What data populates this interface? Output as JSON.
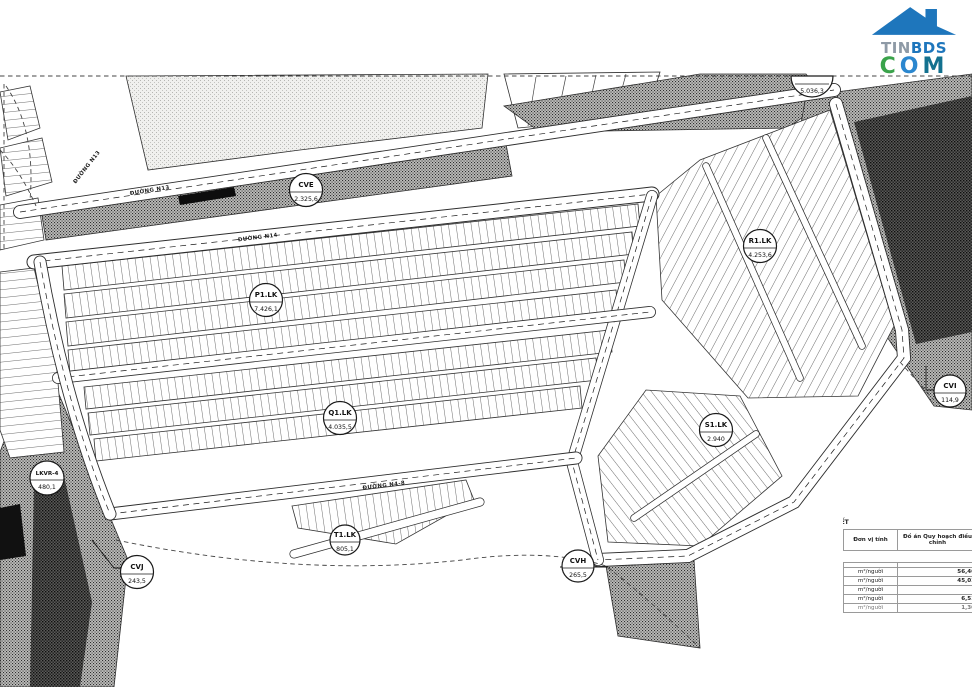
{
  "logo": {
    "tin": "TIN",
    "bds": "BDS",
    "c": "C",
    "o": "O",
    "m": "M",
    "roof_color": "#1e76bc"
  },
  "map": {
    "zones": [
      {
        "name": "CVE",
        "area": "2.325,6"
      },
      {
        "name": "P1.LK",
        "area": "7.426,1"
      },
      {
        "name": "Q1.LK",
        "area": "4.035,5"
      },
      {
        "name": "R1.LK",
        "area": "4.253,6"
      },
      {
        "name": "S1.LK",
        "area": "2.940"
      },
      {
        "name": "T1.LK",
        "area": "805,1"
      },
      {
        "name": "CVH",
        "area": "265,5"
      },
      {
        "name": "CVI",
        "area": "114,9"
      },
      {
        "name": "CVJ",
        "area": "243,5"
      },
      {
        "name": "LKVR-4",
        "area": "480,1"
      }
    ],
    "edge_label": {
      "area": "5.036,3"
    },
    "roads": [
      {
        "name": "ĐƯỜNG N13"
      },
      {
        "name": "ĐƯỜNG N13"
      },
      {
        "name": "ĐƯỜNG N14"
      },
      {
        "name": "ĐƯỜNG N4-8"
      }
    ]
  },
  "table": {
    "title": "GT CHI TIẾT",
    "headers": {
      "unit": "Đơn vị tính",
      "plan": "Đồ án Quy hoạch điều chỉnh"
    },
    "section": "ĐẤT",
    "rows": [
      {
        "unit": "m²/người",
        "value": "56,46"
      },
      {
        "unit": "m²/người",
        "value": "45,01"
      },
      {
        "unit": "m²/người",
        "value": ""
      },
      {
        "unit": "m²/người",
        "value": "6,51"
      },
      {
        "unit": "m²/người",
        "value": "1,30"
      }
    ]
  }
}
